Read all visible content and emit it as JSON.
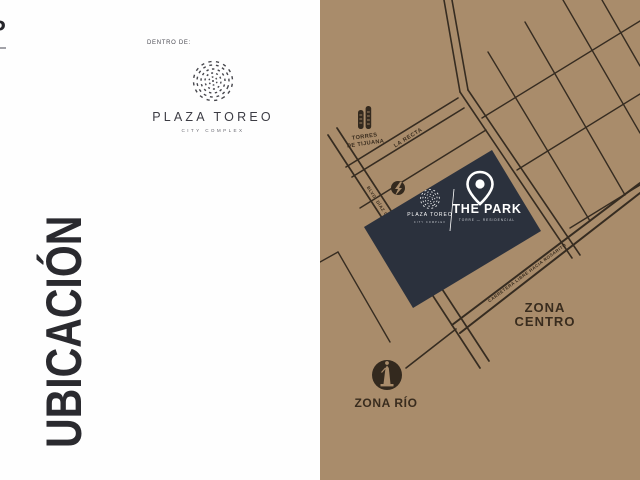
{
  "slide": {
    "left": {
      "corner_fragment": "P",
      "dentro_de": "DENTRO DE:",
      "logo_name": "PLAZA TOREO",
      "logo_tagline": "CITY COMPLEX",
      "title": "UBICACIÓN"
    },
    "map": {
      "streets": {
        "la_recta": "LA RECTA",
        "blvd": "BLVD. DÍAZ ORDAZ",
        "carretera": "CARRETERA LIBRE HACIA ROSARITO"
      },
      "landmarks": {
        "torres_line1": "TORRES",
        "torres_line2": "DE TIJUANA",
        "zona_centro_line1": "ZONA",
        "zona_centro_line2": "CENTRO",
        "zona_rio": "ZONA RÍO"
      },
      "card": {
        "plaza_name": "PLAZA TOREO",
        "plaza_tagline": "CITY COMPLEX",
        "park_name": "THE PARK",
        "park_subtitle": "TORRE — RESIDENCIAL"
      },
      "colors": {
        "background": "#a98c6b",
        "street": "#362c21",
        "card": "#2b313d",
        "label": "#392c1e",
        "white": "#ffffff"
      }
    }
  }
}
